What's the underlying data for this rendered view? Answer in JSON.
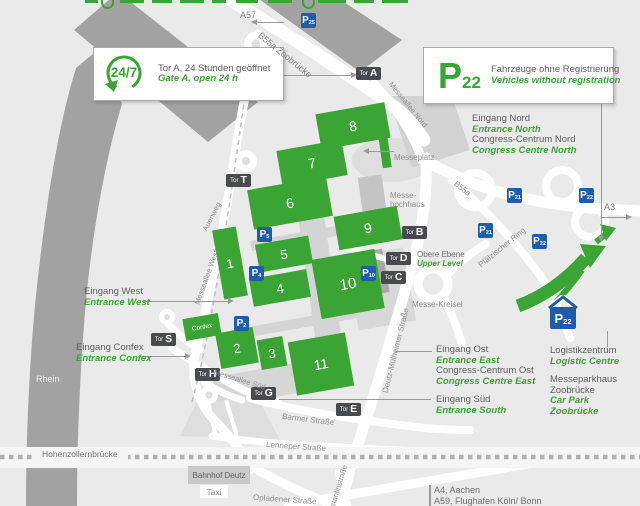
{
  "boxes": {
    "gate_a": {
      "badge": "24/7",
      "de": "Tor A, 24 Stunden geöffnet",
      "en": "Gate A, open 24 h"
    },
    "no_reg": {
      "p": "P",
      "sub": "22",
      "de": "Fahrzeuge ohne Registrierung",
      "en": "Vehicles without registration"
    }
  },
  "halls": {
    "h1": "1",
    "h2": "2",
    "h3": "3",
    "h4": "4",
    "h5": "5",
    "h6": "6",
    "h7": "7",
    "h8": "8",
    "h9": "9",
    "h10": "10",
    "h11": "11",
    "confex": "Confex"
  },
  "gates": {
    "prefix": "Tor",
    "a": "A",
    "b": "B",
    "c": "C",
    "d": "D",
    "e": "E",
    "g": "G",
    "h": "H",
    "s": "S",
    "t": "T"
  },
  "parking": {
    "p": "P",
    "n2": "2",
    "n4": "4",
    "n5": "5",
    "n10": "10",
    "n21": "21",
    "n22": "22",
    "n25": "25"
  },
  "entrances": {
    "north": {
      "de": "Eingang Nord",
      "en": "Entrance North",
      "de2": "Congress-Centrum Nord",
      "en2": "Congress Centre North"
    },
    "west": {
      "de": "Eingang West",
      "en": "Entrance West"
    },
    "confex": {
      "de": "Eingang Confex",
      "en": "Entrance Confex"
    },
    "east": {
      "de": "Eingang Ost",
      "en": "Entrance East",
      "de2": "Congress-Centrum Ost",
      "en2": "Congress Centre East"
    },
    "south": {
      "de": "Eingang Süd",
      "en": "Entrance South"
    }
  },
  "facilities": {
    "logistics": {
      "de": "Logistikzentrum",
      "en": "Logistic Centre"
    },
    "carpark": {
      "de": "Messeparkhaus Zoobrücke",
      "en": "Car Park Zoobrücke"
    },
    "upper_level": {
      "de": "Obere Ebene",
      "en": "Upper Level"
    }
  },
  "streets": {
    "b55a_zoobruecke": "B55a Zoobrücke",
    "b55a": "B55a",
    "messeallee_nord": "Messeallee Nord",
    "messeallee_west": "Messeallee West",
    "messeallee_sued": "Messeallee Süd",
    "auenweg": "Auenweg",
    "pfaelzischer_ring": "Pfälzischer Ring",
    "deutz_muelheimer": "Deutz-Mülheimer Straße",
    "barmer": "Barmer Straße",
    "lenneper": "Lenneper Straße",
    "opladener": "Opladener Straße",
    "constantin": "Constantinstraße",
    "hohenzollernbruecke": "Hohenzollernbrücke"
  },
  "places": {
    "messeplatz": "Messeplatz",
    "messehochhaus": "Messe-hochhaus",
    "messekreisel": "Messe-Kreisel",
    "rhein": "Rhein",
    "bahnhof_deutz": "Bahnhof Deutz",
    "taxi": "Taxi"
  },
  "signs": {
    "a57": "A57",
    "a3": "A3",
    "a4": "A4, Aachen",
    "a59": "A59, Flughafen Köln/ Bonn"
  }
}
